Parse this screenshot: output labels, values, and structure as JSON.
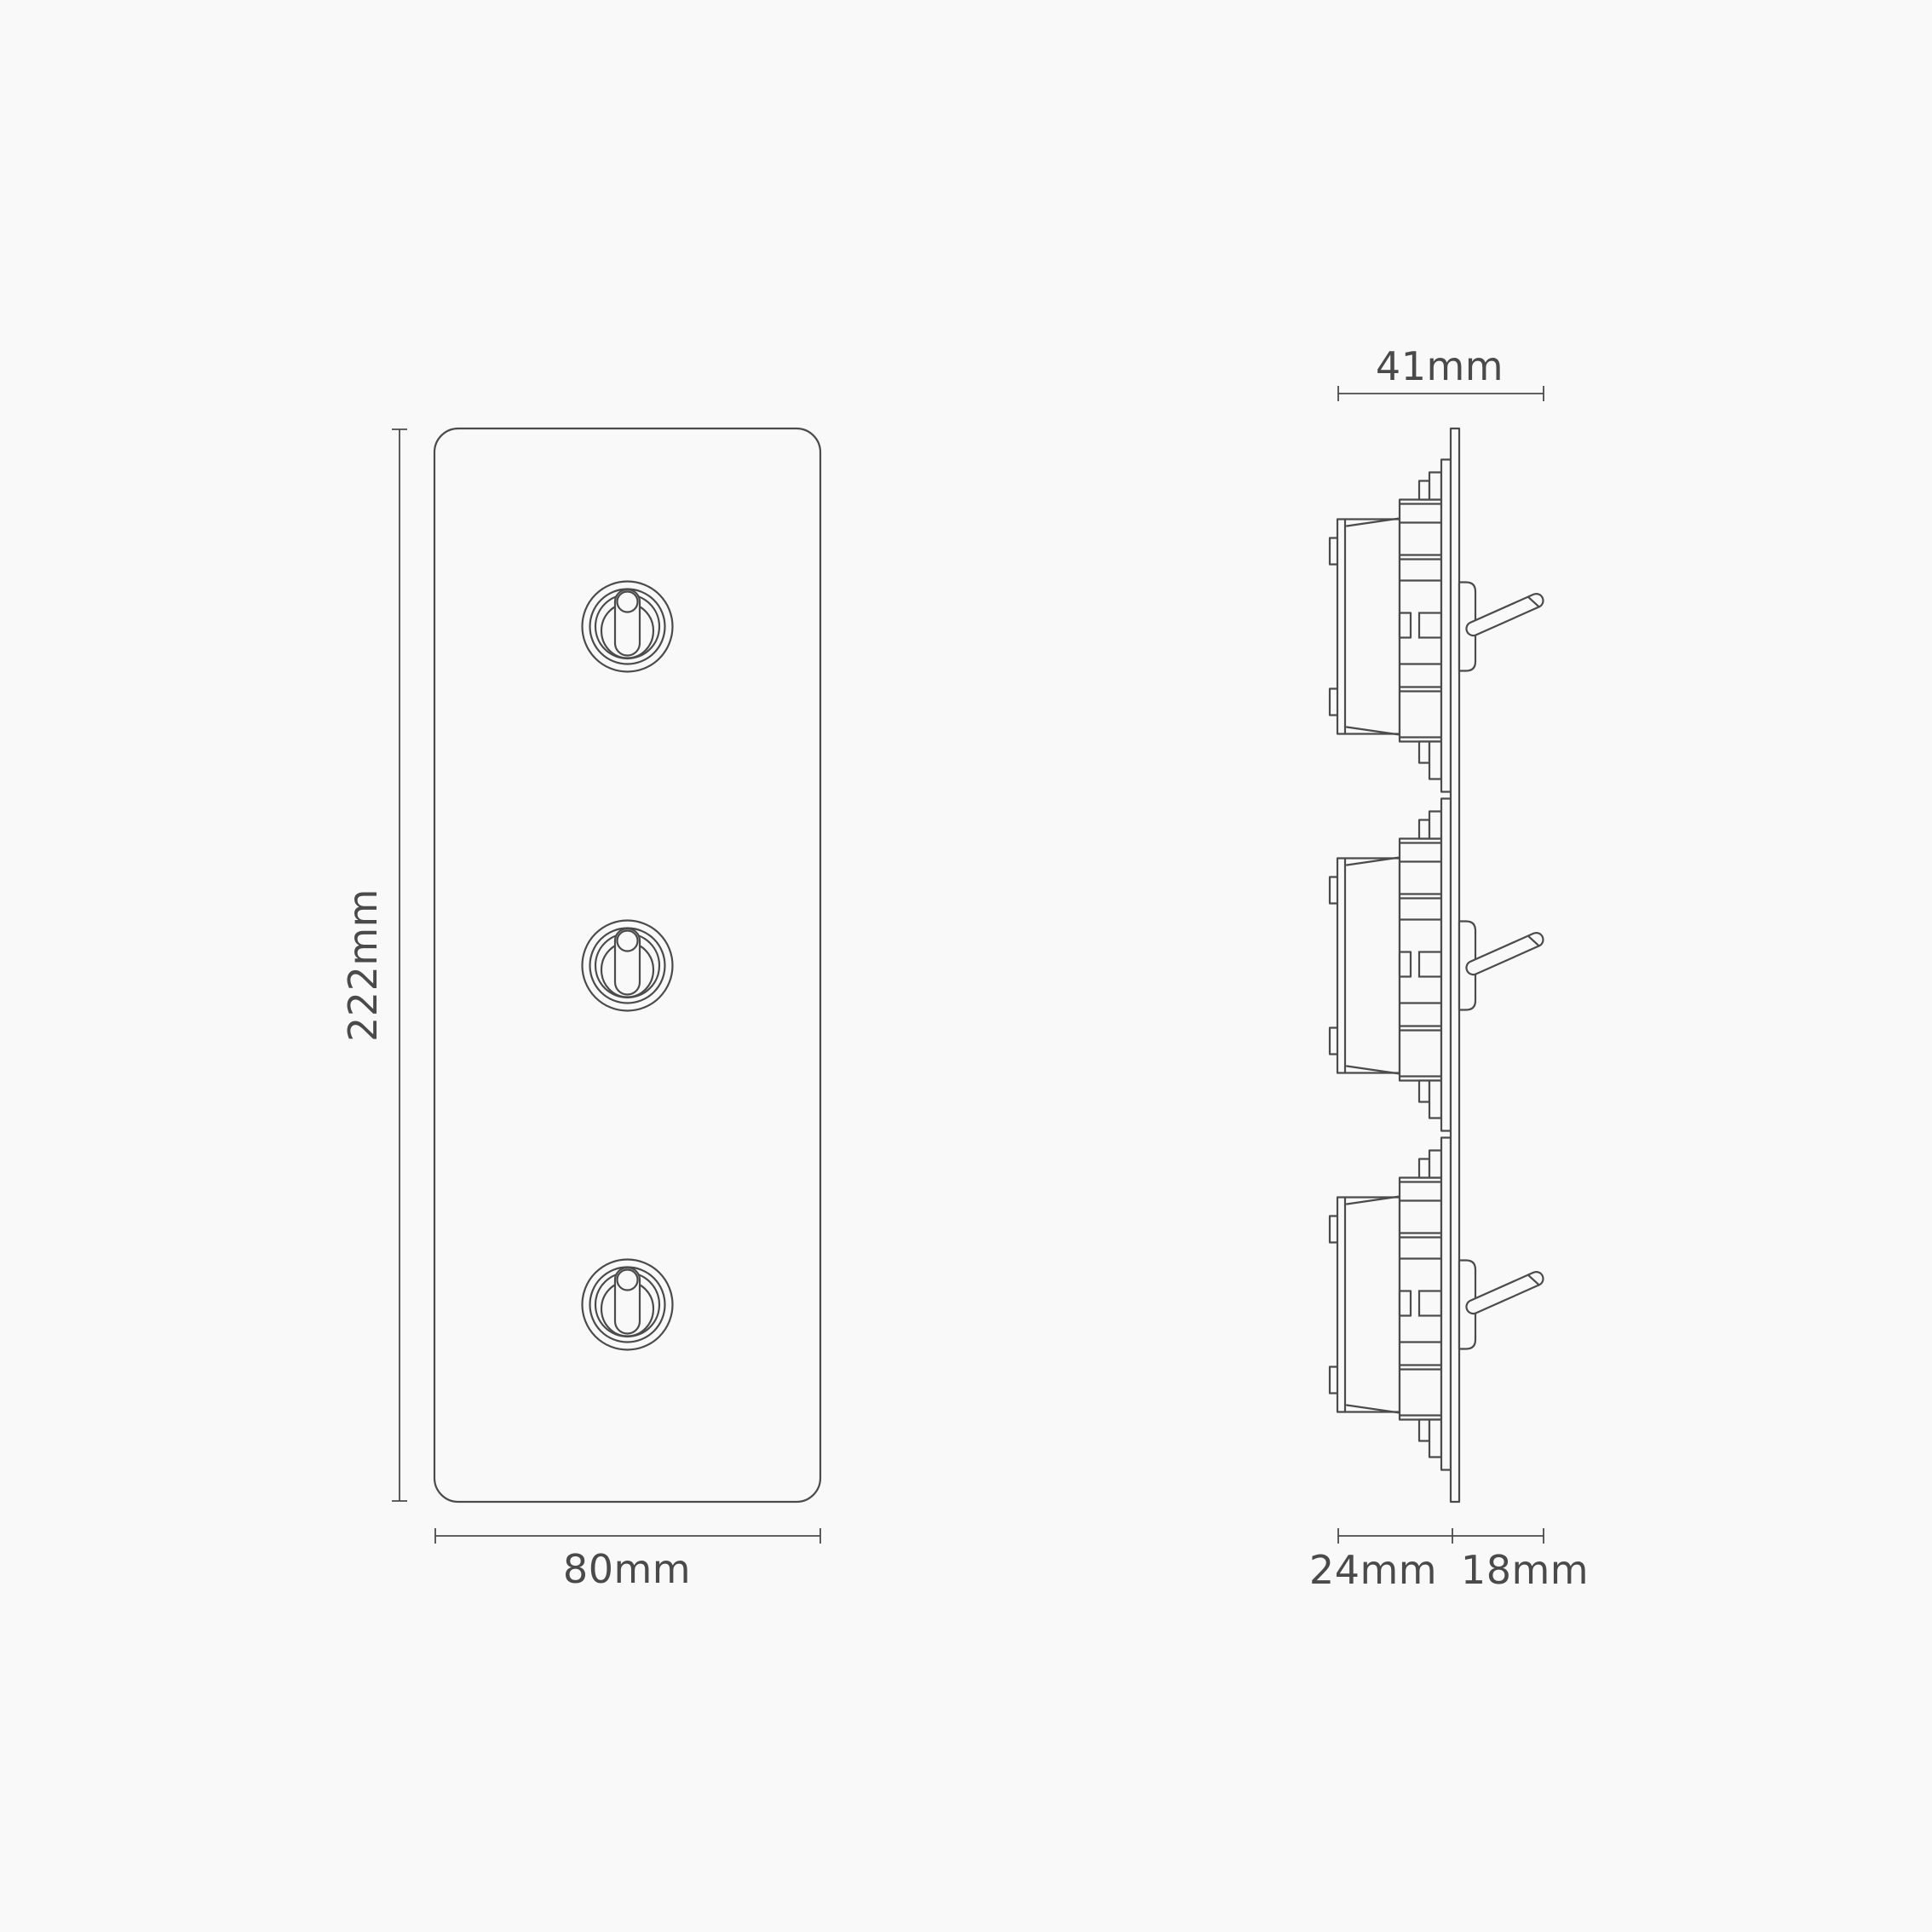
{
  "colors": {
    "background": "#f9f9f9",
    "line": "#4b4b4b",
    "dimension": "#4b4b4b",
    "text": "#4a4a4a"
  },
  "drawing": {
    "subject": "3-gang toggle switch plate technical drawing",
    "views": [
      "front",
      "side"
    ]
  },
  "front_view": {
    "height_label": "222mm",
    "width_label": "80mm",
    "toggle_count": 3
  },
  "side_view": {
    "width_label": "41mm",
    "mechanism_depth_label": "24mm",
    "toggle_projection_label": "18mm",
    "toggle_count": 3
  }
}
